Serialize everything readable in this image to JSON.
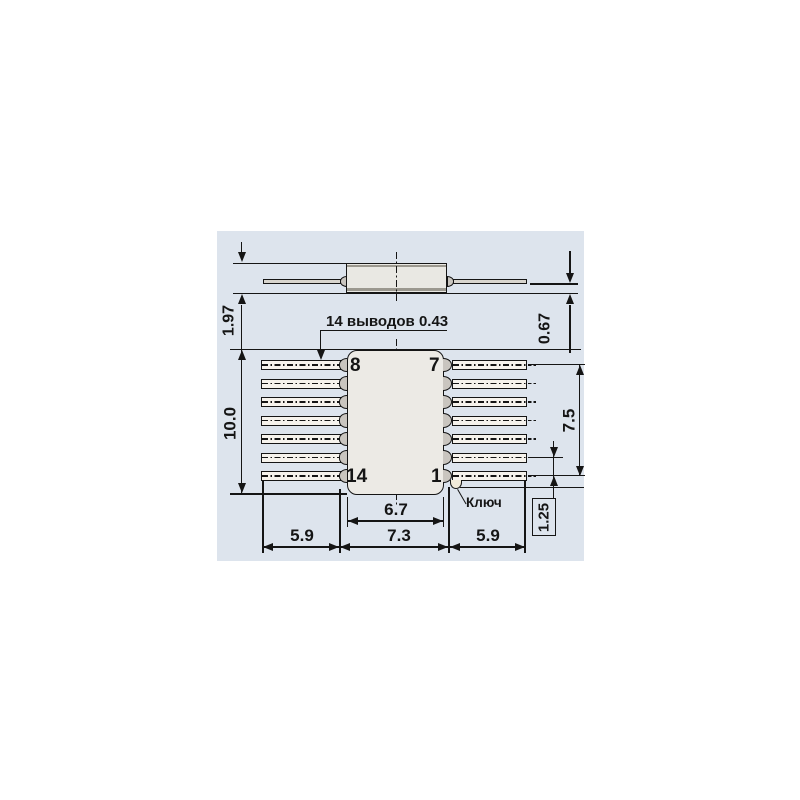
{
  "drawing": {
    "description": "14-pin flat-pack IC package dimensional drawing",
    "colors": {
      "panel_background": "#dde4ed",
      "body_fill": "#eceae5",
      "lead_fill": "#f6f3ed",
      "tab_fill": "#c9c5bf",
      "line": "#151515"
    },
    "side_view": {
      "height_dim": "1.97",
      "lead_offset_dim": "0.67"
    },
    "top_view": {
      "leads_note": "14 выводов 0.43",
      "pins": {
        "top_left": "8",
        "top_right": "7",
        "bottom_left": "14",
        "bottom_right": "1"
      },
      "key_label": "Ключ",
      "dims": {
        "body_height": "10.0",
        "lead_span": "7.5",
        "pitch": "1.25",
        "body_width": "6.7",
        "tab_span": "7.3",
        "lead_left": "5.9",
        "lead_right": "5.9"
      }
    }
  }
}
